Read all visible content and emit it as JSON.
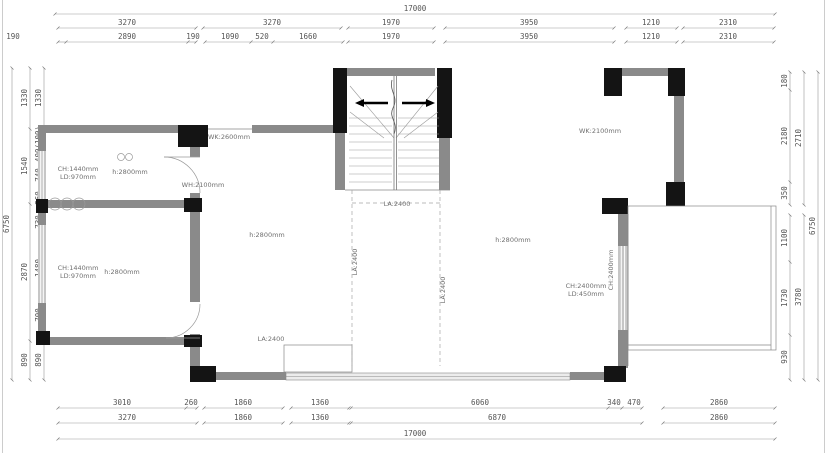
{
  "dims": {
    "top_overall": "17000",
    "top_row1": [
      "3270",
      "3270",
      "1970",
      "3950",
      "1210",
      "2310"
    ],
    "top_row2": [
      "190",
      "2890",
      "190",
      "1090",
      "520",
      "1660",
      "1970",
      "3950",
      "1210",
      "2310"
    ],
    "bottom_row1": [
      "3010",
      "260",
      "1860",
      "1360",
      "6060",
      "340",
      "470",
      "2860"
    ],
    "bottom_row2": [
      "3270",
      "1860",
      "1360",
      "6870",
      "2860"
    ],
    "bottom_overall": "17000",
    "left_overall": "6750",
    "left_col_mid": [
      "1330",
      "1540",
      "2870",
      "890"
    ],
    "left_col_inner": [
      "1330",
      "400(100)",
      "740",
      "360",
      "730",
      "1480",
      "700",
      "890"
    ],
    "right_overall": "6750",
    "right_col_mid": [
      "2710",
      "3780"
    ],
    "right_col_inner": [
      "180",
      "2180",
      "350",
      "1100",
      "1730",
      "930"
    ]
  },
  "annotations": {
    "win_left_top_1": "CH:1440mm",
    "win_left_top_2": "LD:970mm",
    "win_left_bot_1": "CH:1440mm",
    "win_left_bot_2": "LD:970mm",
    "h_room_top_left": "h:2800mm",
    "h_room_bottom_left": "h:2800mm",
    "h_hallway": "h:2800mm",
    "h_living": "h:2800mm",
    "wk_hall": "WK:2600mm",
    "wh_hall": "WH:2100mm",
    "wk_living": "WK:2100mm",
    "la_stair_top": "LA:2400",
    "la_stair_left": "LA:2400",
    "la_stair_right": "LA:2400",
    "la_entry": "LA:2400",
    "win_right_1": "CH:2400mm",
    "win_right_2": "LD:450mm",
    "win_right_rot": "CH:2400mm"
  }
}
